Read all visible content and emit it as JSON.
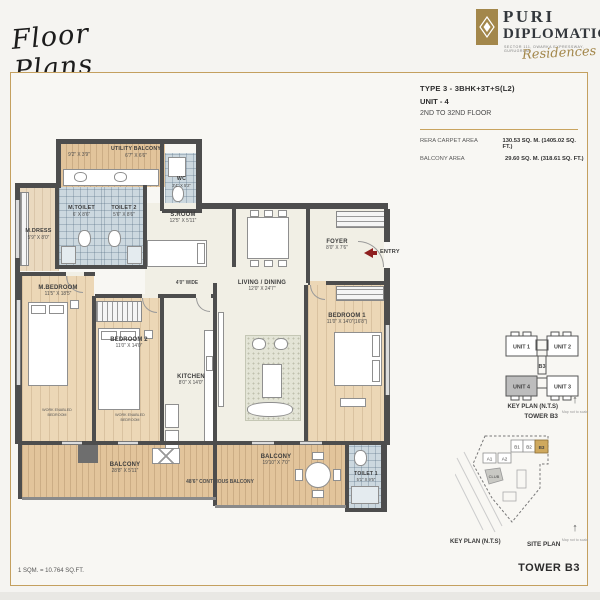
{
  "header": {
    "script_title": "Floor Plans",
    "logo": {
      "line1": "PURI",
      "line2": "DIPLOMATIC",
      "tagline": "SECTOR 111, DWARKA EXPRESSWAY, GURUGRAM",
      "script": "Residences"
    }
  },
  "info": {
    "type_line": "TYPE 3 - 3BHK+3T+S(L2)",
    "unit_line": "UNIT - 4",
    "floor_line": "2ND TO 32ND FLOOR",
    "area_rows": [
      {
        "label": "RERA CARPET AREA",
        "value": "130.53 SQ. M. (1405.02 SQ. FT.)"
      },
      {
        "label": "BALCONY AREA",
        "value": "29.60 SQ. M. (318.61 SQ. FT.)"
      }
    ]
  },
  "plan": {
    "rooms": {
      "utility_balcony": {
        "name": "UTILITY BALCONY",
        "dim": "6'7\" X 6'6\"",
        "dim2": "9'2\" X 3'9\""
      },
      "wc": {
        "name": "WC",
        "dim": "3'4\" X 5'2\""
      },
      "m_toilet": {
        "name": "M.TOILET",
        "dim": "6' X 8'6\""
      },
      "toilet2": {
        "name": "TOILET 2",
        "dim": "5'6\" X 8'6\""
      },
      "m_dress": {
        "name": "M.DRESS",
        "dim": "5'9\" X 8'0\""
      },
      "s_room": {
        "name": "S.ROOM",
        "dim": "12'5\" X 5'11\""
      },
      "foyer": {
        "name": "FOYER",
        "dim": "8'0\" X 7'6\""
      },
      "living": {
        "name": "LIVING / DINING",
        "dim": "12'0\" X 24'7\""
      },
      "m_bedroom": {
        "name": "M.BEDROOM",
        "dim": "11'5\" X 18'5\""
      },
      "bedroom2": {
        "name": "BEDROOM 2",
        "dim": "11'0\" X 14'0\""
      },
      "bedroom1": {
        "name": "BEDROOM 1",
        "dim": "11'0\" X 14'0\"(16'8\")"
      },
      "kitchen": {
        "name": "KITCHEN",
        "dim": "8'0\" X 14'0\""
      },
      "balcony_left": {
        "name": "BALCONY",
        "dim": "28'8\" X 5'11\""
      },
      "balcony_right": {
        "name": "BALCONY",
        "dim": "19'10\" X 7'0\""
      },
      "toilet1": {
        "name": "TOILET 1",
        "dim": "5'1\" X 9'5\""
      }
    },
    "labels": {
      "entry": "ENTRY",
      "corridor": "4'0\" WIDE",
      "continuous_balcony": "48'6\" CONTINOUS BALCONY",
      "work_enabled": "WORK ENABLED BEDROOM"
    }
  },
  "keyplan": {
    "unit1": "UNIT 1",
    "unit2": "UNIT 2",
    "unit3": "UNIT 3",
    "unit4": "UNIT 4",
    "tower": "B3",
    "caption": "KEY PLAN (N.T.S)",
    "tower_caption": "TOWER B3",
    "map_note": "Map not to scale"
  },
  "siteplan": {
    "a1": "A1",
    "a2": "A2",
    "b1": "B1",
    "b2": "B2",
    "b3": "B3",
    "club": "CLUB",
    "caption_left": "KEY PLAN (N.T.S)",
    "caption_right": "SITE PLAN",
    "map_note": "Map not to scale"
  },
  "footer": {
    "sqm_note": "1 SQM. = 10.764 SQ.FT.",
    "tower_label": "TOWER B3"
  },
  "colors": {
    "gold": "#b3955a",
    "wall": "#4d4d4d",
    "entry_red": "#8e1f1f"
  }
}
